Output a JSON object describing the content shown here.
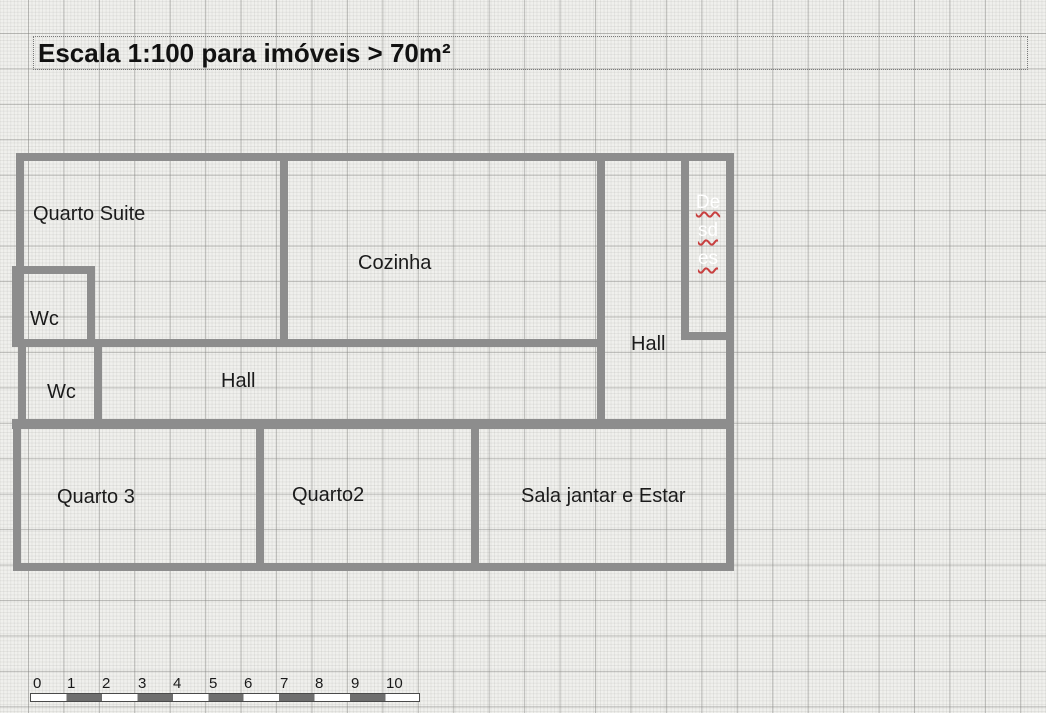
{
  "title": {
    "text": "Escala 1:100 para imóveis > 70m²"
  },
  "rooms": {
    "quarto_suite": {
      "label": "Quarto Suite"
    },
    "cozinha": {
      "label": "Cozinha"
    },
    "wc_suite": {
      "label": "Wc"
    },
    "wc_hall": {
      "label": "Wc"
    },
    "hall_middle": {
      "label": "Hall"
    },
    "hall_right": {
      "label": "Hall"
    },
    "quarto3": {
      "label": "Quarto 3"
    },
    "quarto2": {
      "label": "Quarto2"
    },
    "sala": {
      "label": "Sala jantar e Estar"
    },
    "despensa": {
      "lines": [
        "De",
        "sd",
        "es"
      ]
    }
  },
  "ruler": {
    "labels": [
      "0",
      "1",
      "2",
      "3",
      "4",
      "5",
      "6",
      "7",
      "8",
      "9",
      "10"
    ]
  },
  "colors": {
    "wall": "#8d8d8d",
    "background": "#f0f0ed",
    "grid_major": "#b4b4b2",
    "label_text": "#1b1b1b",
    "despensa_text": "#ffffff",
    "spellcheck_underline": "#c84040",
    "ruler_dark_segment": "#6e6e6e"
  }
}
